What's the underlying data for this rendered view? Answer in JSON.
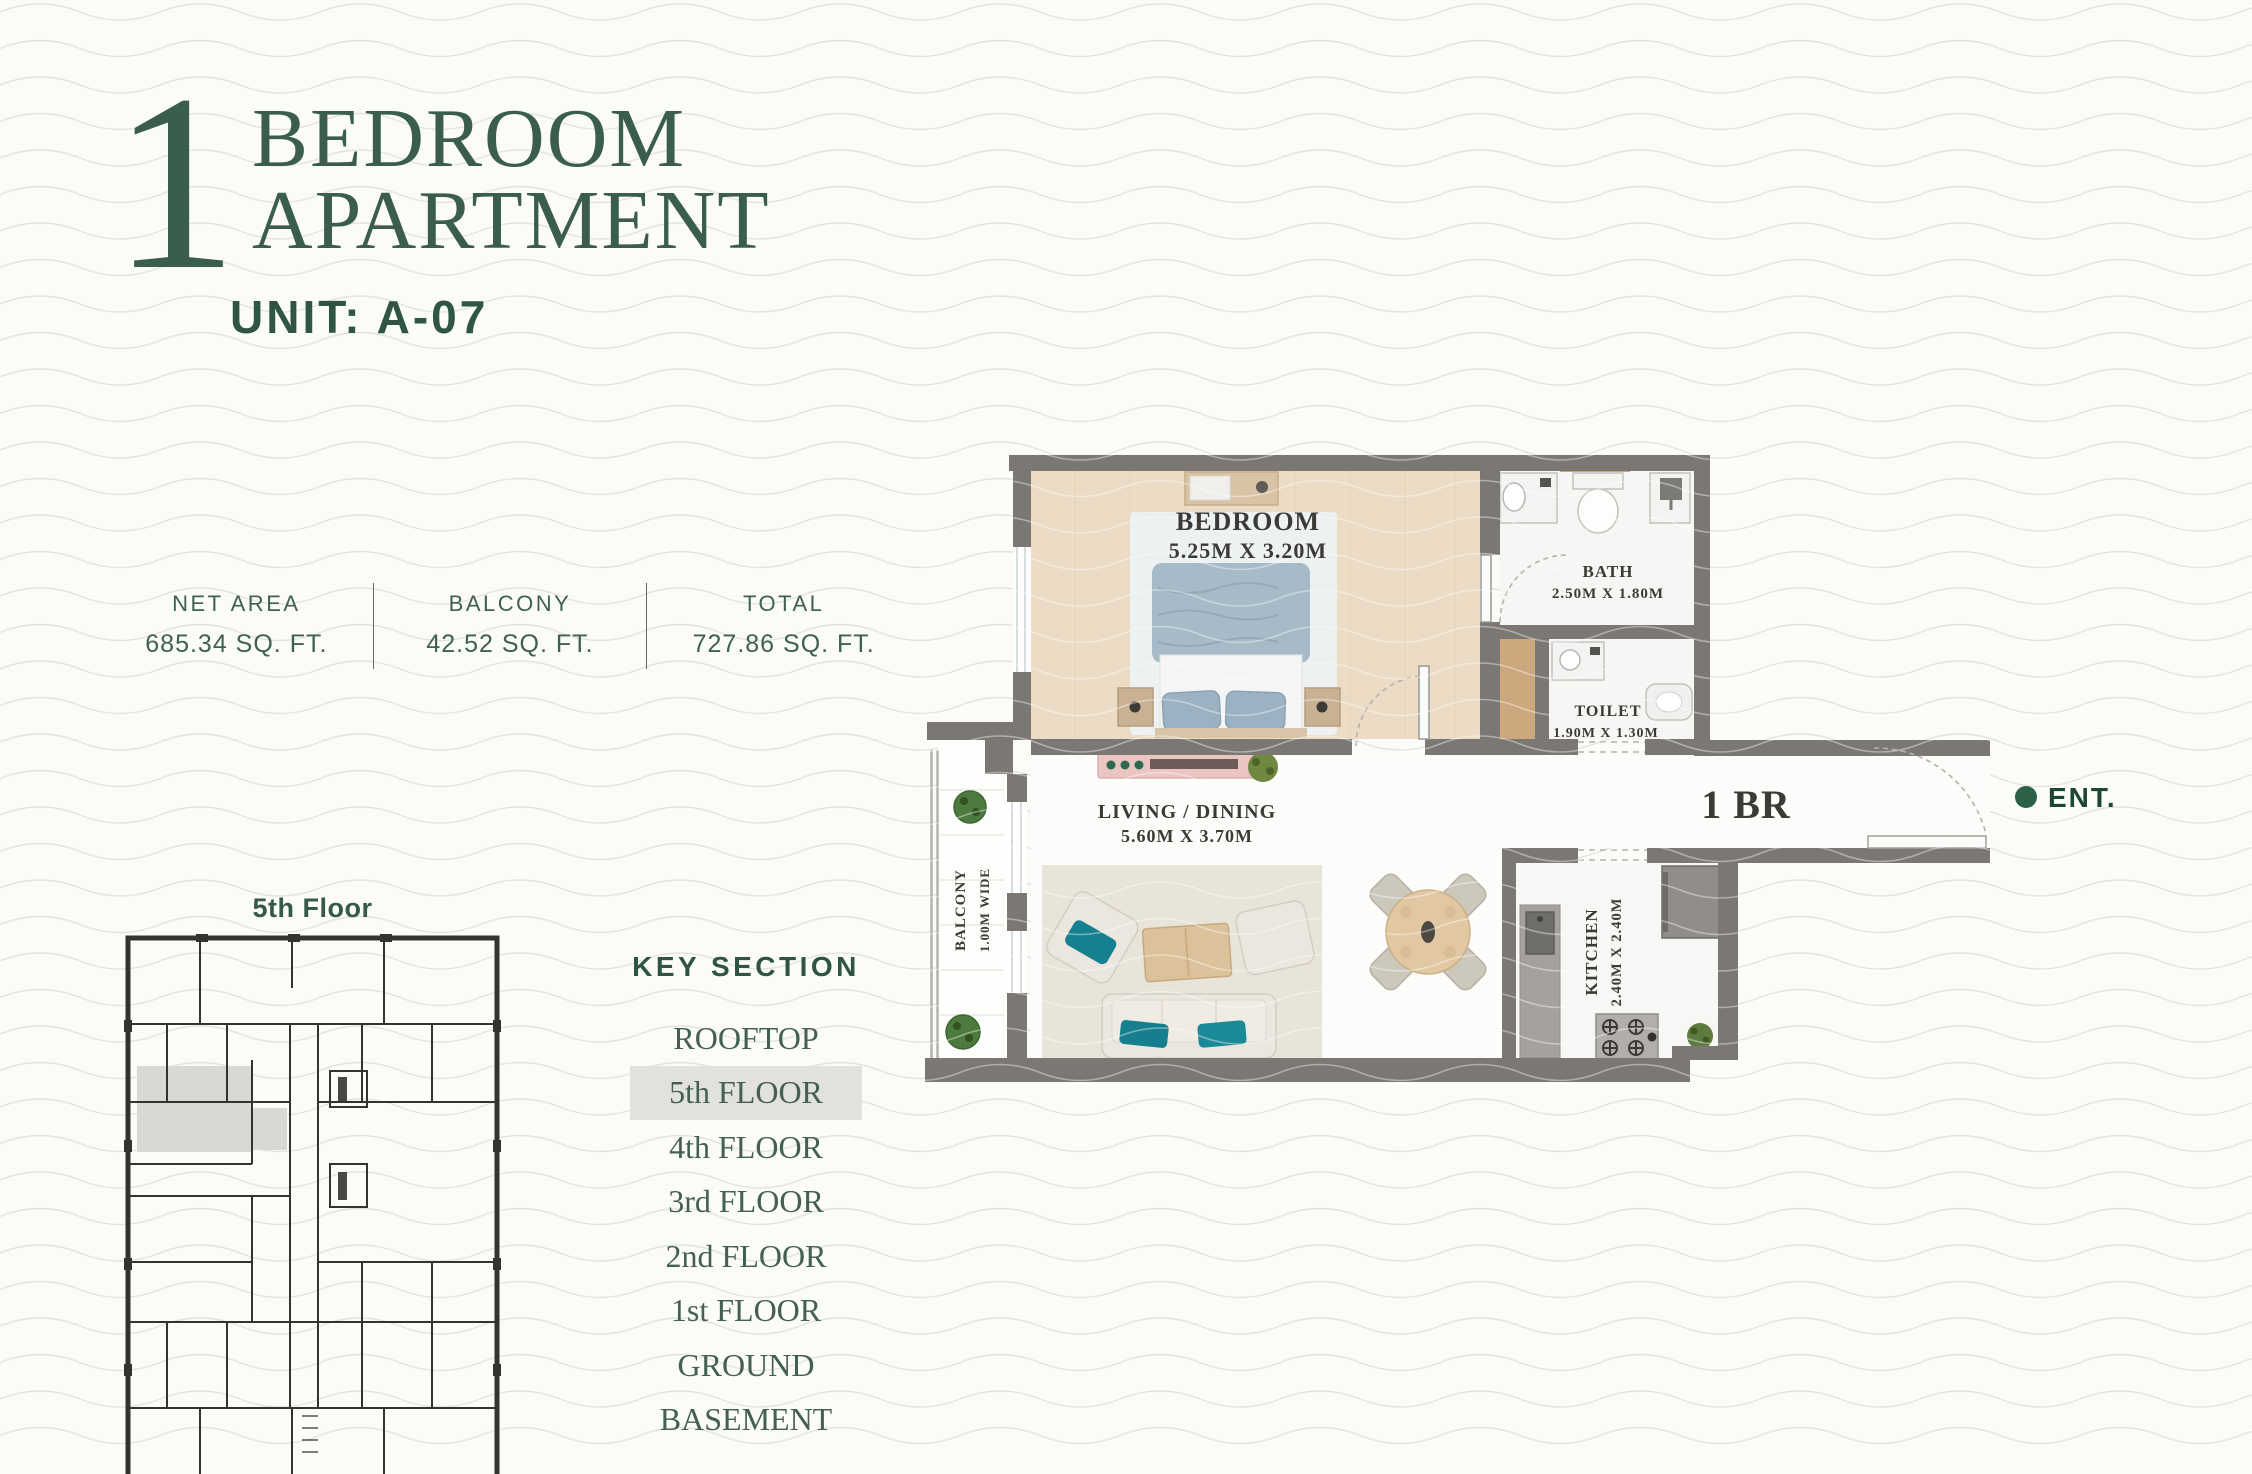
{
  "title": {
    "number": "1",
    "line1": "BEDROOM",
    "line2": "APARTMENT",
    "unit": "UNIT: A-07"
  },
  "stats": {
    "items": [
      {
        "label": "NET AREA",
        "value": "685.34 SQ. FT."
      },
      {
        "label": "BALCONY",
        "value": "42.52 SQ. FT."
      },
      {
        "label": "TOTAL",
        "value": "727.86 SQ. FT."
      }
    ]
  },
  "mini_plan": {
    "caption": "5th Floor"
  },
  "key_section": {
    "title": "KEY SECTION",
    "floors": [
      "ROOFTOP",
      "5th FLOOR",
      "4th FLOOR",
      "3rd FLOOR",
      "2nd FLOOR",
      "1st FLOOR",
      "GROUND",
      "BASEMENT"
    ],
    "active_floor": "5th FLOOR"
  },
  "floor_plan": {
    "bedroom": {
      "name": "BEDROOM",
      "dims": "5.25M X 3.20M"
    },
    "bath": {
      "name": "BATH",
      "dims": "2.50M X 1.80M"
    },
    "toilet": {
      "name": "TOILET",
      "dims": "1.90M X 1.30M"
    },
    "living": {
      "name": "LIVING / DINING",
      "dims": "5.60M X 3.70M"
    },
    "kitchen": {
      "name": "KITCHEN",
      "dims": "2.40M X 2.40M"
    },
    "balcony": {
      "name": "BALCONY",
      "dims": "1.00M WIDE"
    },
    "unit_type": "1 BR",
    "entrance": "ENT."
  },
  "colors": {
    "accent": "#3b5e4c",
    "wall": "#7b7874",
    "highlight": "#e2e1dd",
    "teal": "#17818f",
    "entrance_dot": "#2d6147"
  }
}
